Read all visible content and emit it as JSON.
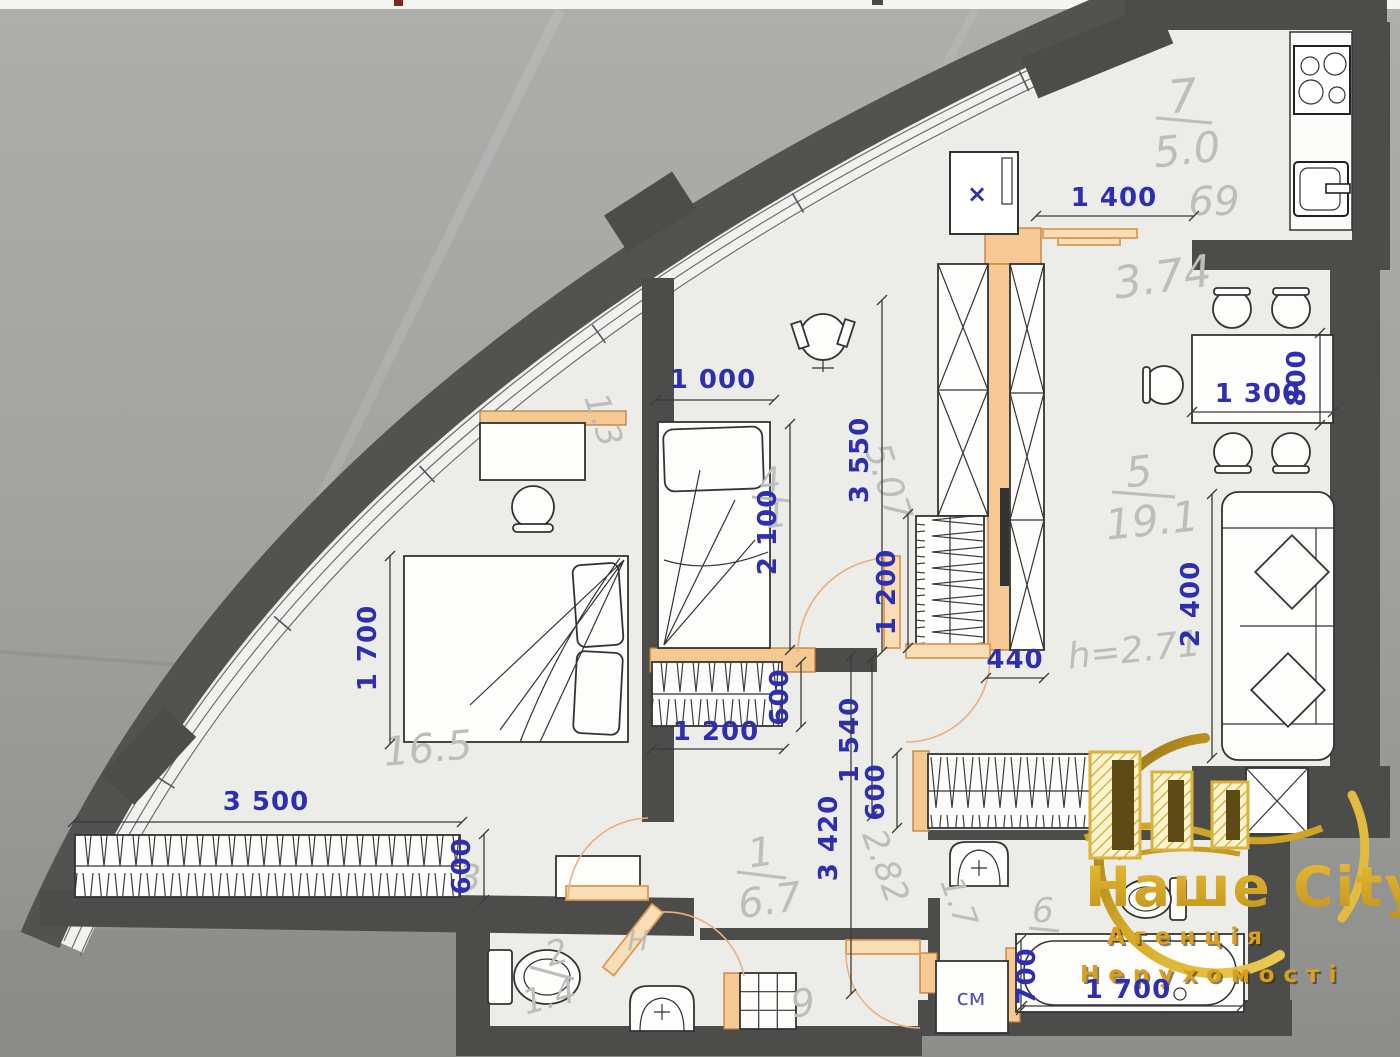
{
  "dims": {
    "d1400": "1 400",
    "d1000": "1 000",
    "d1300": "1 300",
    "d800": "800",
    "d3550": "3 550",
    "d2100": "2 100",
    "d1200v": "1 200",
    "d440": "440",
    "d2400": "2 400",
    "d1700bed": "1 700",
    "d3500": "3 500",
    "d600wl": "600",
    "d600wh": "600",
    "d1200h": "1 200",
    "d1540": "1 540",
    "d600hr": "600",
    "d3420": "3 420",
    "d1700tub": "1 700",
    "d700": "700"
  },
  "marks": {
    "washer": "см",
    "fridge": "×"
  },
  "rooms": {
    "kitchen": {
      "num": "7",
      "area": "5.0"
    },
    "living": {
      "num": "5",
      "area": "19.1",
      "height": "h=2.71"
    },
    "bedroom": {
      "num": "4",
      "area": "1"
    },
    "hall": {
      "num": "1",
      "area": "6.7"
    },
    "wc": {
      "num": "2",
      "area": "1.4"
    },
    "bath": {
      "num": "6"
    }
  },
  "faded": {
    "f69": "69",
    "f374": "3.74",
    "f507": "5.07",
    "f13": "1.3",
    "f165": "16.5",
    "f3": "3",
    "f282": "2.82",
    "f17": "1.7",
    "fH": "H",
    "f9": "9"
  },
  "logo": {
    "title": "Наше City",
    "sub1": "Агенція",
    "sub2": "Нерухомості"
  }
}
